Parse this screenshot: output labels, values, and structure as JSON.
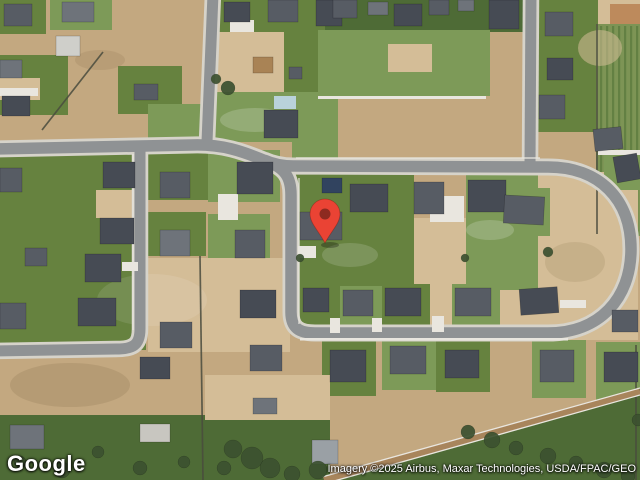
{
  "map": {
    "provider_logo": "Google",
    "attribution": "Imagery ©2025 Airbus, Maxar Technologies, USDA/FPAC/GEO",
    "view_type": "satellite",
    "palette": {
      "dirt": "#c3a880",
      "dirtL": "#d4bd97",
      "dirtO": "#bd8a5c",
      "grass": "#66823f",
      "grassL": "#7d9a58",
      "grassD": "#4e6b36",
      "farm": "#7d9455",
      "farmRow": "#5d7a3e",
      "concrete": "#e9e6df",
      "pool": "#b9d2da",
      "roofD": "#464b54",
      "roofM": "#575c64",
      "roofL": "#6e737a",
      "road": "#8f9294",
      "casing": "#d6d3ca",
      "fence": "#4a4c3e",
      "tree": "#3c5130",
      "pin_body": "#EA4334",
      "pin_inner": "#8E2A20"
    },
    "marker": {
      "cx": 325,
      "cy": 214,
      "r": 15,
      "tipY": 243,
      "innerR": 5.5
    },
    "fields": [
      {
        "x": 0,
        "y": 0,
        "w": 46,
        "h": 34,
        "c": "grass"
      },
      {
        "x": 50,
        "y": 0,
        "w": 62,
        "h": 30,
        "c": "grassL"
      },
      {
        "x": 0,
        "y": 55,
        "w": 68,
        "h": 60,
        "c": "grass"
      },
      {
        "x": 0,
        "y": 78,
        "w": 40,
        "h": 22,
        "c": "dirtL"
      },
      {
        "x": 118,
        "y": 66,
        "w": 64,
        "h": 48,
        "c": "grass"
      },
      {
        "x": 148,
        "y": 104,
        "w": 56,
        "h": 36,
        "c": "grassL"
      },
      {
        "x": 214,
        "y": 0,
        "w": 126,
        "h": 32,
        "c": "grass"
      },
      {
        "x": 214,
        "y": 32,
        "w": 74,
        "h": 60,
        "c": "dirtL"
      },
      {
        "x": 284,
        "y": 28,
        "w": 50,
        "h": 66,
        "c": "grass"
      },
      {
        "x": 206,
        "y": 92,
        "w": 86,
        "h": 50,
        "c": "grassL"
      },
      {
        "x": 292,
        "y": 92,
        "w": 46,
        "h": 72,
        "c": "grassL"
      },
      {
        "x": 325,
        "y": 0,
        "w": 272,
        "h": 32,
        "c": "grassD"
      },
      {
        "x": 318,
        "y": 30,
        "w": 172,
        "h": 66,
        "c": "grassL"
      },
      {
        "x": 388,
        "y": 44,
        "w": 44,
        "h": 28,
        "c": "dirtL"
      },
      {
        "x": 536,
        "y": 0,
        "w": 62,
        "h": 132,
        "c": "grass"
      },
      {
        "x": 598,
        "y": 0,
        "w": 42,
        "h": 26,
        "c": "dirtL"
      },
      {
        "x": 610,
        "y": 4,
        "w": 30,
        "h": 24,
        "c": "dirtO"
      },
      {
        "x": 596,
        "y": 24,
        "w": 44,
        "h": 212,
        "c": "farm"
      },
      {
        "x": 500,
        "y": 172,
        "w": 138,
        "h": 168,
        "c": "dirtL"
      },
      {
        "x": 498,
        "y": 188,
        "w": 52,
        "h": 48,
        "c": "grassL"
      },
      {
        "x": 294,
        "y": 170,
        "w": 120,
        "h": 162,
        "c": "grass"
      },
      {
        "x": 414,
        "y": 218,
        "w": 52,
        "h": 114,
        "c": "dirtL"
      },
      {
        "x": 466,
        "y": 170,
        "w": 72,
        "h": 120,
        "c": "grassL"
      },
      {
        "x": 0,
        "y": 146,
        "w": 146,
        "h": 204,
        "c": "grass"
      },
      {
        "x": 96,
        "y": 190,
        "w": 50,
        "h": 28,
        "c": "dirtL"
      },
      {
        "x": 146,
        "y": 152,
        "w": 62,
        "h": 48,
        "c": "grass"
      },
      {
        "x": 208,
        "y": 150,
        "w": 72,
        "h": 52,
        "c": "grassL"
      },
      {
        "x": 146,
        "y": 212,
        "w": 60,
        "h": 44,
        "c": "grass"
      },
      {
        "x": 208,
        "y": 214,
        "w": 62,
        "h": 48,
        "c": "grassL"
      },
      {
        "x": 148,
        "y": 258,
        "w": 142,
        "h": 94,
        "c": "dirtL"
      },
      {
        "x": 296,
        "y": 282,
        "w": 42,
        "h": 50,
        "c": "grass"
      },
      {
        "x": 340,
        "y": 286,
        "w": 42,
        "h": 46,
        "c": "grassL"
      },
      {
        "x": 384,
        "y": 284,
        "w": 46,
        "h": 48,
        "c": "grass"
      },
      {
        "x": 452,
        "y": 284,
        "w": 48,
        "h": 48,
        "c": "grassL"
      },
      {
        "x": 322,
        "y": 340,
        "w": 54,
        "h": 56,
        "c": "grass"
      },
      {
        "x": 382,
        "y": 338,
        "w": 54,
        "h": 52,
        "c": "grassL"
      },
      {
        "x": 436,
        "y": 340,
        "w": 54,
        "h": 52,
        "c": "grass"
      },
      {
        "x": 532,
        "y": 340,
        "w": 54,
        "h": 58,
        "c": "grassL"
      },
      {
        "x": 596,
        "y": 342,
        "w": 44,
        "h": 62,
        "c": "grassL"
      },
      {
        "x": 604,
        "y": 150,
        "w": 36,
        "h": 40,
        "c": "grassL"
      },
      {
        "x": 205,
        "y": 375,
        "w": 125,
        "h": 48,
        "c": "dirtL"
      },
      {
        "x": 205,
        "y": 420,
        "w": 125,
        "h": 60,
        "c": "grassD"
      },
      {
        "x": 0,
        "y": 415,
        "w": 205,
        "h": 65,
        "c": "grassD"
      },
      {
        "poly": "326,480 640,388 640,480",
        "c": "grassD"
      }
    ],
    "blotches": [
      [
        152,
        300,
        55,
        26,
        "#ffffff",
        0.1
      ],
      [
        70,
        385,
        60,
        22,
        "#8a7450",
        0.25
      ],
      [
        255,
        120,
        35,
        12,
        "#ffffff",
        0.18
      ],
      [
        575,
        262,
        30,
        20,
        "#8a7450",
        0.18
      ],
      [
        350,
        255,
        28,
        12,
        "#ffffff",
        0.15
      ],
      [
        600,
        48,
        22,
        18,
        "#d4bd97",
        0.55
      ],
      [
        100,
        60,
        25,
        10,
        "#8a7450",
        0.2
      ],
      [
        490,
        230,
        24,
        10,
        "#ffffff",
        0.18
      ]
    ],
    "roads": [
      {
        "d": "M -6,149 L 192,145 C 222,144 242,151 266,161",
        "w": 11.5
      },
      {
        "d": "M 266,161 C 285,168 291,177 291,195 L 291,312 C 291,328 299,333 315,333 L 548,333 C 599,333 631,299 631,249 C 631,199 599,167 548,167 L 293,166 C 282,166 273,164 264,160",
        "w": 11.5
      },
      {
        "d": "M 213,-6 L 207,142",
        "w": 11
      },
      {
        "d": "M 531,-6 L 530,164",
        "w": 11
      },
      {
        "d": "M 140,143 L 140,329 C 140,346 132,349 116,349 L -6,351",
        "w": 11
      }
    ],
    "sidewalks": [
      "M 299,178 L 299,324",
      "M 133,154 L 133,330",
      "M 296,158 L 540,158"
    ],
    "fences": [
      [
        103,
        52,
        42,
        130
      ],
      [
        200,
        256,
        203,
        480
      ],
      [
        597,
        24,
        597,
        234
      ],
      [
        636,
        345,
        636,
        480
      ]
    ],
    "ditch": [
      {
        "d": "M 324,480 L 640,391",
        "c": "#a8855c",
        "w": 7
      },
      {
        "d": "M 322,477 L 640,388",
        "c": "#e9e6df",
        "w": 1.3
      },
      {
        "d": "M 327,483 L 640,395",
        "c": "#e9e6df",
        "w": 1.3
      }
    ],
    "pads": [
      [
        318,
        96,
        168,
        3
      ],
      [
        300,
        338,
        268,
        2.5
      ],
      [
        0,
        88,
        38,
        8
      ],
      [
        230,
        20,
        24,
        12
      ],
      [
        430,
        196,
        34,
        26
      ],
      [
        218,
        194,
        20,
        26
      ],
      [
        122,
        262,
        16,
        9
      ],
      [
        330,
        318,
        10,
        15
      ],
      [
        372,
        318,
        10,
        14
      ],
      [
        432,
        316,
        12,
        16
      ],
      [
        298,
        246,
        18,
        12
      ],
      [
        560,
        300,
        26,
        8
      ],
      [
        598,
        150,
        42,
        5
      ],
      [
        274,
        96,
        22,
        13,
        "pool"
      ]
    ],
    "structures": [
      [
        4,
        4,
        28,
        22,
        "roofM"
      ],
      [
        62,
        2,
        32,
        20,
        "roofL"
      ],
      [
        56,
        36,
        24,
        20,
        "#cfcfca"
      ],
      [
        0,
        60,
        22,
        18,
        "roofL"
      ],
      [
        2,
        96,
        28,
        20,
        "roofD"
      ],
      [
        134,
        84,
        24,
        16,
        "roofM"
      ],
      [
        224,
        2,
        26,
        20,
        "roofD"
      ],
      [
        268,
        0,
        30,
        22,
        "roofM"
      ],
      [
        316,
        0,
        26,
        26,
        "roofD"
      ],
      [
        253,
        57,
        20,
        16,
        "#a98355"
      ],
      [
        289,
        67,
        13,
        12,
        "roofM"
      ],
      [
        333,
        0,
        24,
        18,
        "roofM"
      ],
      [
        368,
        2,
        20,
        13,
        "roofL"
      ],
      [
        394,
        4,
        28,
        22,
        "roofD"
      ],
      [
        429,
        0,
        20,
        15,
        "roofM"
      ],
      [
        458,
        0,
        16,
        11,
        "roofL"
      ],
      [
        489,
        0,
        30,
        29,
        "roofD"
      ],
      [
        545,
        12,
        28,
        24,
        "roofM"
      ],
      [
        547,
        58,
        26,
        22,
        "roofD"
      ],
      [
        539,
        95,
        26,
        24,
        "roofM"
      ],
      [
        594,
        128,
        28,
        22,
        "roofM",
        -6
      ],
      [
        615,
        155,
        24,
        26,
        "roofD",
        -10
      ],
      [
        237,
        162,
        36,
        32,
        "roofD"
      ],
      [
        322,
        178,
        20,
        15,
        "#31435f"
      ],
      [
        300,
        212,
        42,
        28,
        "roofM"
      ],
      [
        350,
        184,
        38,
        28,
        "roofD"
      ],
      [
        414,
        182,
        30,
        32,
        "roofM"
      ],
      [
        468,
        180,
        38,
        32,
        "roofD"
      ],
      [
        504,
        196,
        40,
        28,
        "roofM",
        3
      ],
      [
        520,
        288,
        38,
        26,
        "roofD",
        -4
      ],
      [
        103,
        162,
        32,
        26,
        "roofD"
      ],
      [
        0,
        168,
        22,
        24,
        "roofM"
      ],
      [
        160,
        172,
        30,
        26,
        "roofM"
      ],
      [
        100,
        218,
        34,
        26,
        "roofD"
      ],
      [
        160,
        230,
        30,
        26,
        "roofL"
      ],
      [
        25,
        248,
        22,
        18,
        "roofM"
      ],
      [
        85,
        254,
        36,
        28,
        "roofD"
      ],
      [
        0,
        303,
        26,
        26,
        "roofM"
      ],
      [
        78,
        298,
        38,
        28,
        "roofD"
      ],
      [
        160,
        322,
        32,
        26,
        "roofM"
      ],
      [
        140,
        357,
        30,
        22,
        "roofD"
      ],
      [
        235,
        230,
        30,
        28,
        "roofM"
      ],
      [
        240,
        290,
        36,
        28,
        "roofD"
      ],
      [
        250,
        345,
        32,
        26,
        "roofM"
      ],
      [
        303,
        288,
        26,
        24,
        "roofD"
      ],
      [
        343,
        290,
        30,
        26,
        "roofM"
      ],
      [
        385,
        288,
        36,
        28,
        "roofD"
      ],
      [
        455,
        288,
        36,
        28,
        "roofM"
      ],
      [
        330,
        350,
        36,
        32,
        "roofD"
      ],
      [
        390,
        346,
        36,
        28,
        "roofM"
      ],
      [
        445,
        350,
        34,
        28,
        "roofD"
      ],
      [
        540,
        350,
        34,
        32,
        "roofM"
      ],
      [
        604,
        352,
        34,
        30,
        "roofD"
      ],
      [
        612,
        310,
        26,
        22,
        "roofM"
      ],
      [
        253,
        398,
        24,
        16,
        "roofL"
      ],
      [
        312,
        440,
        26,
        24,
        "#9aa0a5"
      ],
      [
        10,
        425,
        34,
        24,
        "roofL"
      ],
      [
        140,
        424,
        30,
        18,
        "#c8c6c0"
      ],
      [
        264,
        110,
        34,
        28,
        "roofD"
      ]
    ],
    "trees": [
      [
        228,
        88,
        7
      ],
      [
        216,
        79,
        5
      ],
      [
        233,
        449,
        9
      ],
      [
        252,
        458,
        11
      ],
      [
        270,
        468,
        10
      ],
      [
        292,
        474,
        8
      ],
      [
        318,
        470,
        9
      ],
      [
        224,
        468,
        7
      ],
      [
        62,
        470,
        8
      ],
      [
        98,
        452,
        6
      ],
      [
        140,
        468,
        7
      ],
      [
        184,
        462,
        6
      ],
      [
        20,
        462,
        6
      ],
      [
        468,
        432,
        7
      ],
      [
        492,
        440,
        8
      ],
      [
        516,
        448,
        7
      ],
      [
        548,
        456,
        8
      ],
      [
        576,
        463,
        7
      ],
      [
        604,
        470,
        8
      ],
      [
        628,
        476,
        7
      ],
      [
        638,
        420,
        6
      ],
      [
        548,
        252,
        5
      ],
      [
        300,
        258,
        4
      ],
      [
        465,
        258,
        4
      ]
    ]
  }
}
